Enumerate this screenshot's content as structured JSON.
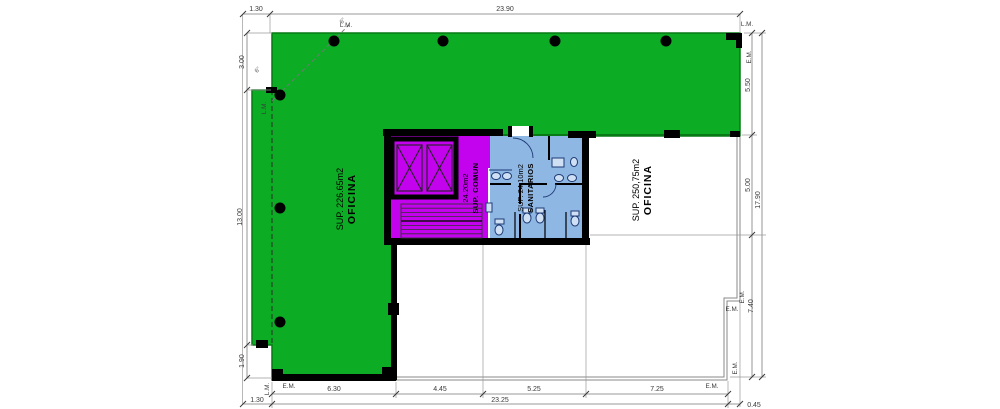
{
  "plan": {
    "regions": {
      "oficina_left": {
        "title": "OFICINA",
        "area": "SUP. 226.65m2",
        "fill": "#0CAD25"
      },
      "oficina_right": {
        "title": "OFICINA",
        "area": "SUP. 250,75m2",
        "fill": "#FFFFFF"
      },
      "sup_comun": {
        "title": "SUP. COMUN",
        "area": "24.20m2",
        "fill": "#C403EE"
      },
      "sanitarios": {
        "title": "SANITARIOS",
        "area": "SUP. 24,10m2",
        "fill": "#8FB7E4"
      }
    },
    "dimensions": {
      "top": {
        "offset_left": "1.30",
        "total": "23.90"
      },
      "left": {
        "segments": [
          "3.00",
          "13.00",
          "1.90"
        ]
      },
      "right": {
        "segments": [
          "5.50",
          "5.00",
          "7.40"
        ],
        "total": "17.90"
      },
      "bottom": {
        "segments": [
          "6.30",
          "4.45",
          "5.25",
          "7.25"
        ],
        "offset_left": "1.30",
        "total": "23.25",
        "offset_right": "0.45"
      }
    },
    "markers": {
      "property_line": "L.M.",
      "building_line": "E.M.",
      "angle_note": "6''"
    },
    "colors": {
      "wall": "#000000",
      "dimension": "#3A3A3A",
      "green_border": "#077A15",
      "fixture_outline": "#1D3A74"
    }
  }
}
